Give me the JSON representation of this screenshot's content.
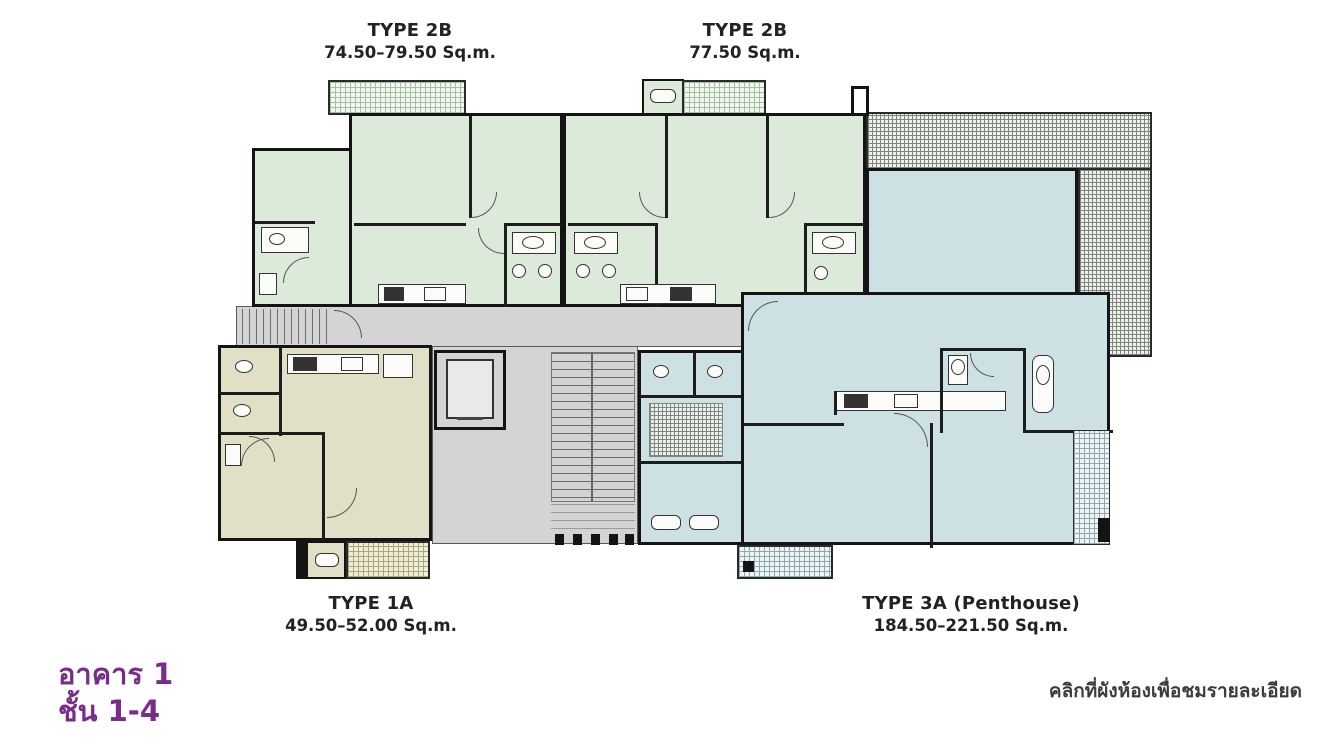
{
  "plan": {
    "unit_labels": {
      "type2b_left": {
        "title": "TYPE 2B",
        "area": "74.50–79.50 Sq.m."
      },
      "type2b_right": {
        "title": "TYPE 2B",
        "area": "77.50 Sq.m."
      },
      "type1a": {
        "title": "TYPE 1A",
        "area": "49.50–52.00 Sq.m."
      },
      "type3a": {
        "title": "TYPE 3A (Penthouse)",
        "area": "184.50–221.50 Sq.m."
      }
    },
    "building": {
      "name": "อาคาร 1",
      "floors": "ชั้น 1-4"
    },
    "hint": "คลิกที่ผังห้องเพื่อชมรายละเอียด",
    "colors": {
      "purple_text": "#7B2B8A",
      "label_text": "#222222",
      "hint_text": "#3C3C3C",
      "unit_green": "#DCEAD9",
      "unit_blue": "#CDE0E4",
      "unit_yellow": "#E1DFC5",
      "common_gray": "#D5D3D3",
      "wall": "#141414"
    }
  }
}
